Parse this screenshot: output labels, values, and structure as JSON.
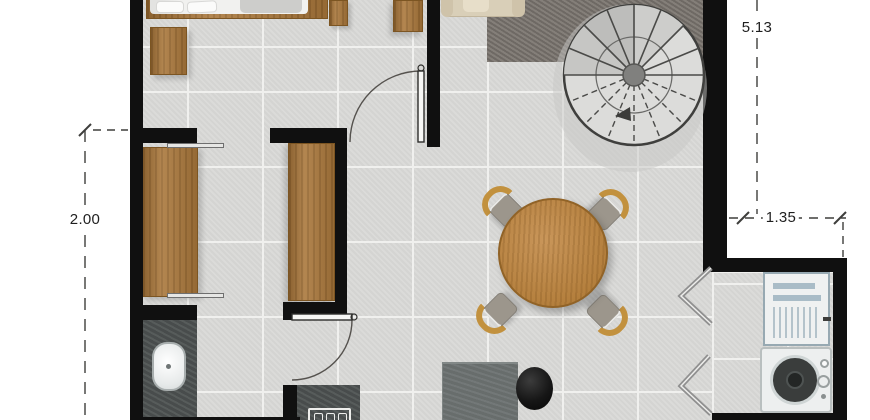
{
  "plan": {
    "type": "residential floor plan, top-down rendered view",
    "rooms": [
      "bedroom",
      "walk-in closet",
      "bathroom",
      "living and dining area",
      "kitchen nook"
    ],
    "furniture": [
      "double bed",
      "bedroom dresser",
      "side cabinet",
      "nightstand",
      "wardrobe left",
      "wardrobe right",
      "bathroom counter with oval sink",
      "cooktop counter",
      "desk",
      "black desk chair",
      "round wooden dining table",
      "four dining chairs",
      "beige sofa",
      "dark gray area rug",
      "spiral staircase",
      "refrigerator",
      "washing machine"
    ],
    "annotations": {
      "right_vertical": "5.13",
      "left_vertical": "2.00",
      "right_horizontal": "1.35"
    },
    "colors": {
      "wall": "#101010",
      "tile": "#d9d9d7",
      "grout": "#f0f0ee",
      "wood": "#aa783c",
      "wood_edge": "#7c5522",
      "table_wood": "#bb8748",
      "chair_back": "#c2913e",
      "seat": "#9c968c",
      "counter": "#4e5352",
      "rug": "#7b756f",
      "sofa": "#d9cfb8",
      "appliance": "#eff1f1",
      "dim_line": "#3e3e3c",
      "dim_text": "#1f1f1f"
    }
  }
}
